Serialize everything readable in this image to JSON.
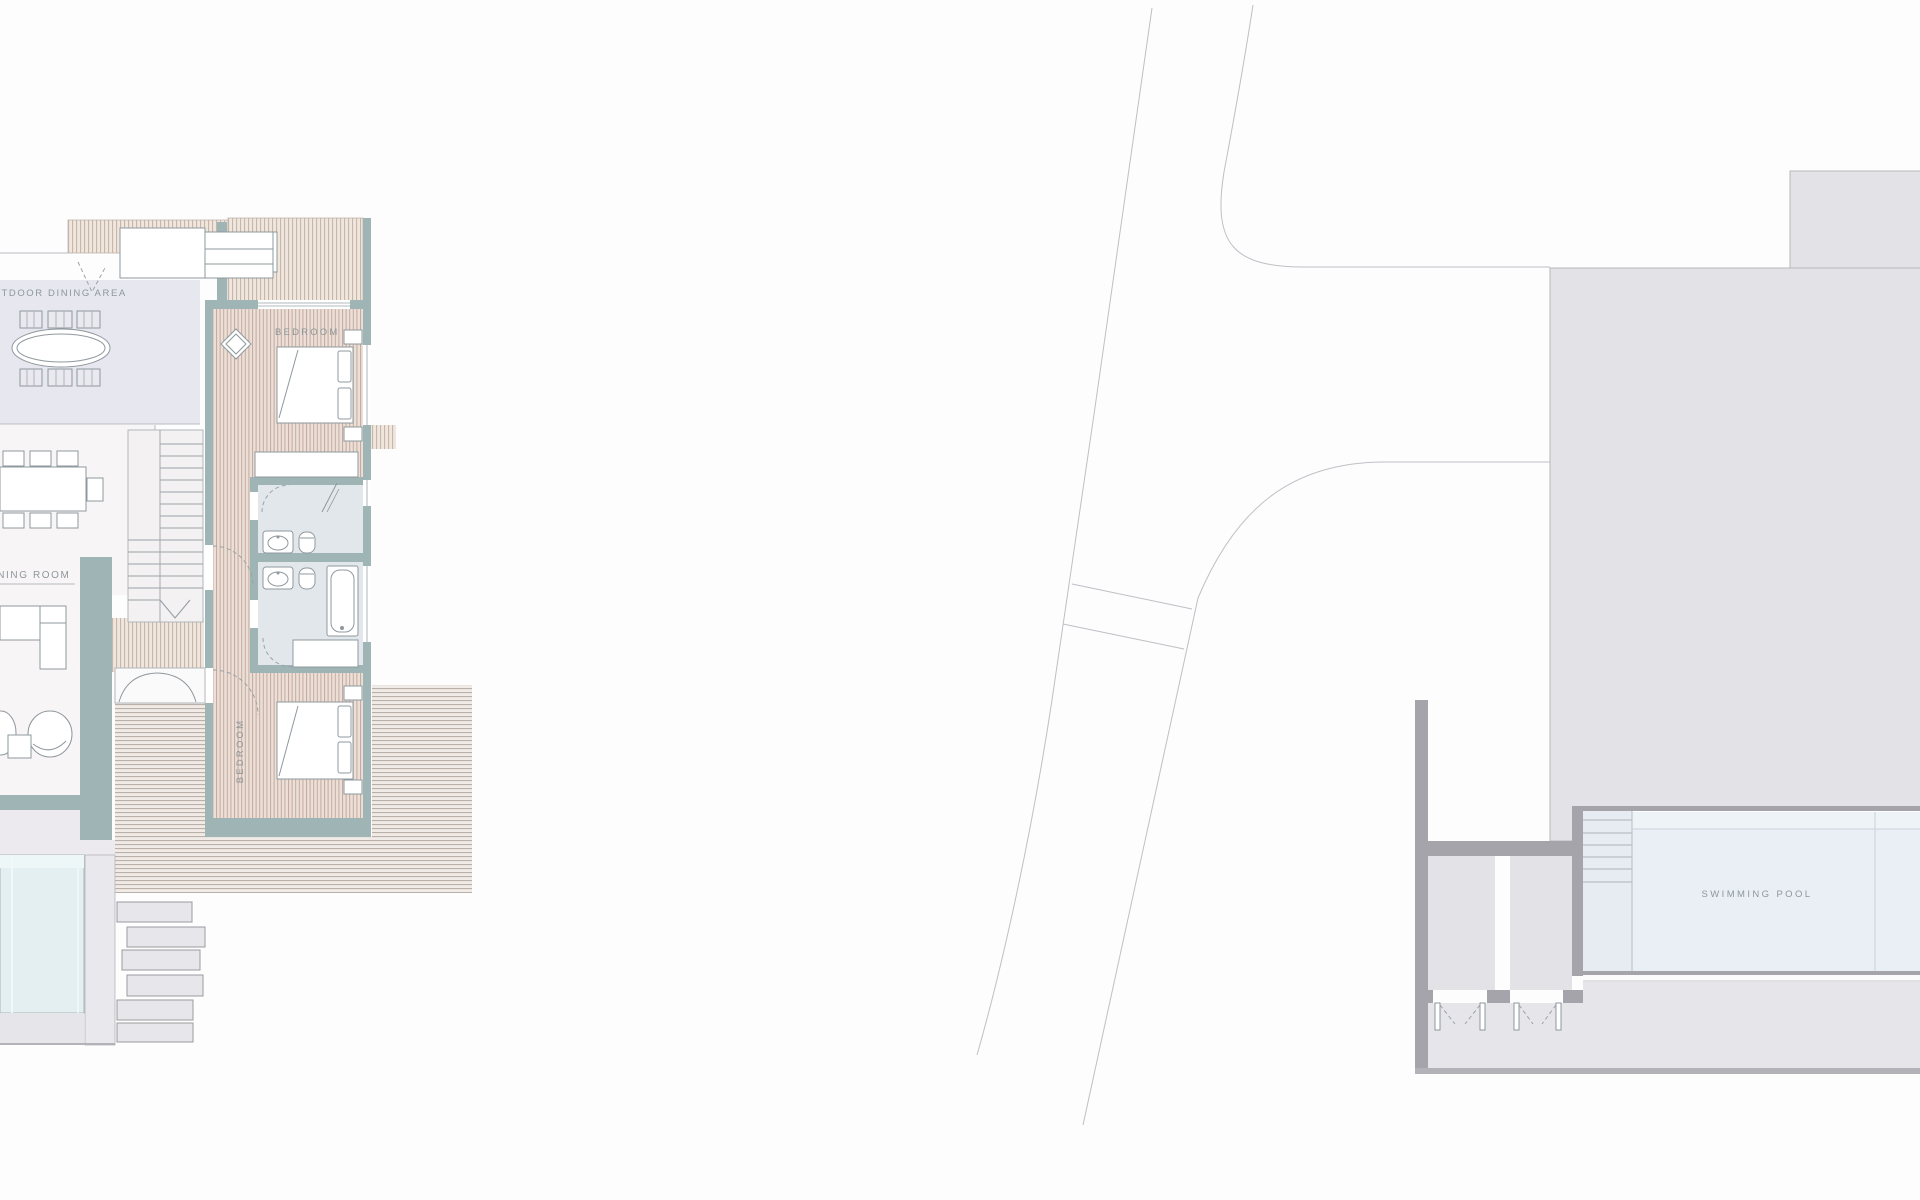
{
  "labels": {
    "outdoor_dining_area": "OUTDOOR DINING AREA",
    "dining_room": "DINING ROOM",
    "bedroom_upper": "BEDROOM",
    "bedroom_lower": "BEDROOM",
    "swimming_pool": "SWIMMING POOL"
  },
  "colors": {
    "background": "#fdfdfe",
    "site_terrace_grey": "#e3e2e7",
    "wall_dark_grey": "#a5a4aa",
    "wall_teal": "#9fb4b4",
    "swimming_pool_water": "#e9eff5",
    "pool_steps_fill": "#e6ecf1",
    "plunge_pool_water": "#e3eff1",
    "walkway_grey": "#e6e5e9",
    "outdoor_dining_fill": "#e7e8ef",
    "bathroom_fill": "#e2e7ec",
    "interior_fill": "#f8f5f6",
    "label_text": "#8e979c",
    "road_line": "#bfbfc5"
  }
}
